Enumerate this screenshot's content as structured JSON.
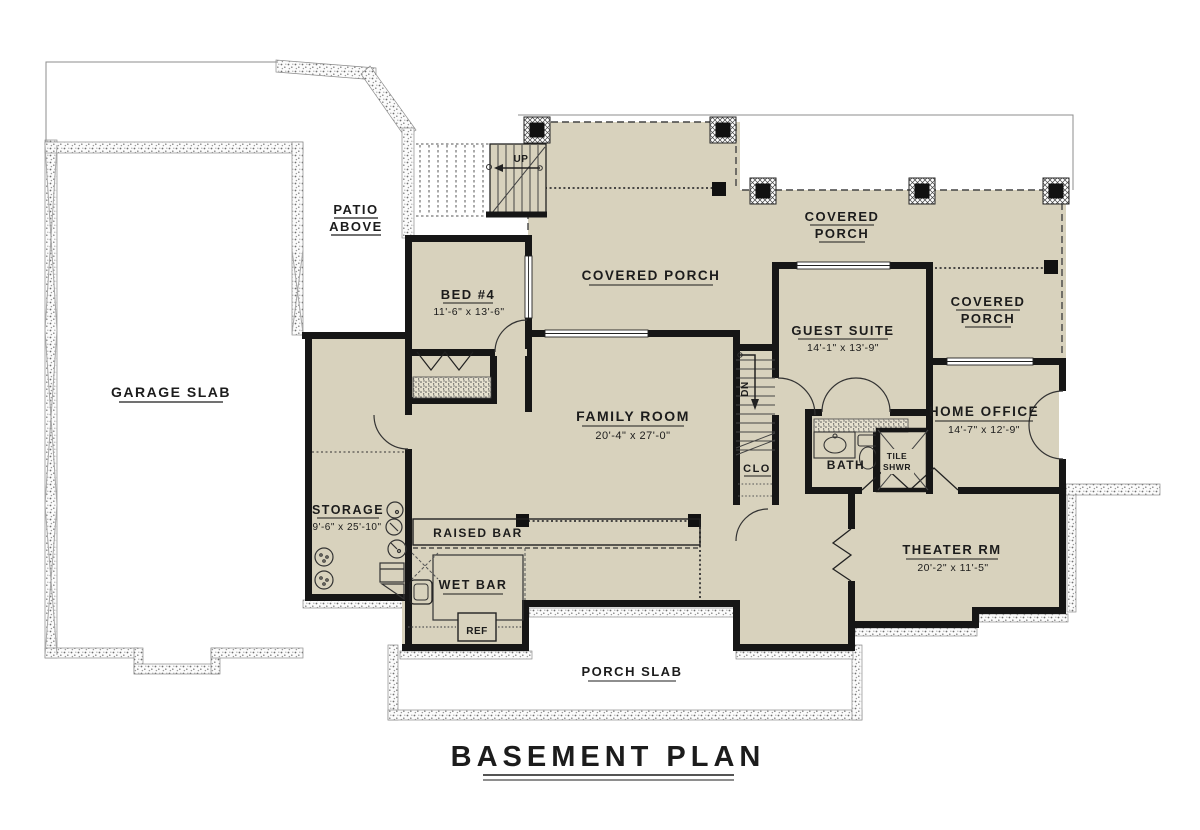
{
  "plan": {
    "title": "BASEMENT PLAN",
    "colors": {
      "floor": "#d8d2bd",
      "wall": "#161616",
      "ink": "#1c1c1c",
      "paper": "#ffffff"
    },
    "areas": {
      "garage_slab": "GARAGE SLAB",
      "patio_line1": "PATIO",
      "patio_line2": "ABOVE",
      "porch_slab": "PORCH SLAB",
      "covered_porch": "COVERED PORCH",
      "covered": "COVERED",
      "porch": "PORCH"
    },
    "rooms": {
      "bed4": {
        "name": "BED #4",
        "dims": "11'-6\" x 13'-6\""
      },
      "family": {
        "name": "FAMILY ROOM",
        "dims": "20'-4\" x 27'-0\""
      },
      "guest": {
        "name": "GUEST SUITE",
        "dims": "14'-1\" x 13'-9\""
      },
      "office": {
        "name": "HOME OFFICE",
        "dims": "14'-7\" x 12'-9\""
      },
      "theater": {
        "name": "THEATER RM",
        "dims": "20'-2\" x 11'-5\""
      },
      "storage": {
        "name": "STORAGE",
        "dims": "9'-6\" x 25'-10\""
      }
    },
    "features": {
      "bath": "BATH",
      "tile": "TILE",
      "shwr": "SHWR",
      "clo": "CLO",
      "raised_bar": "RAISED BAR",
      "wet_bar": "WET BAR",
      "ref": "REF",
      "up": "UP",
      "dn": "DN"
    }
  }
}
